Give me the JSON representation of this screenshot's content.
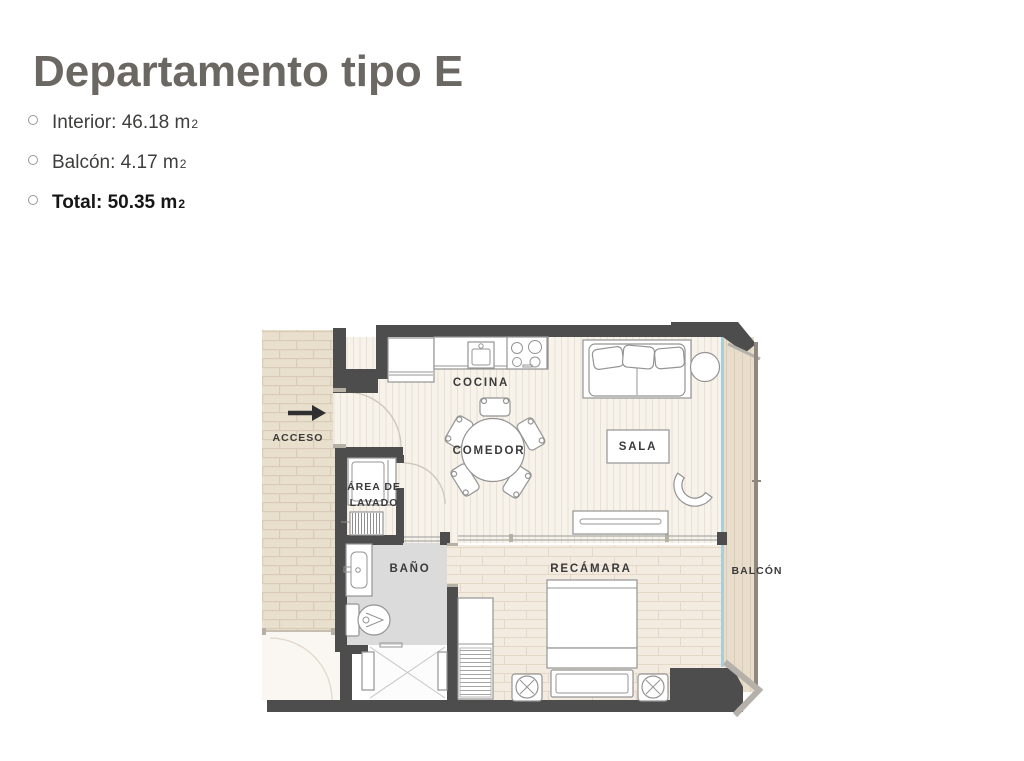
{
  "header": {
    "title": "Departamento tipo E"
  },
  "specs": {
    "items": [
      {
        "text": "Interior: 46.18 m",
        "sup": "2"
      },
      {
        "text": "Balcón: 4.17 m",
        "sup": "2"
      },
      {
        "text": "Total: 50.35 m",
        "sup": "2"
      }
    ]
  },
  "floorplan": {
    "labels": {
      "cocina": "COCINA",
      "comedor": "COMEDOR",
      "sala": "SALA",
      "acceso": "ACCESO",
      "lavado1": "ÁREA DE",
      "lavado2": "LAVADO",
      "bano": "BAÑO",
      "recamara": "RECÁMARA",
      "balcon": "BALCÓN"
    },
    "colors": {
      "wall": "#4d4d4d",
      "floor-living": "#f7f2ea",
      "floor-living-line": "#e8e0d4",
      "floor-bed": "#f3ebe0",
      "floor-bed-line": "#e5d8c7",
      "brick": "#e9dfcd",
      "brick-line": "#d9cbb5",
      "balcony": "#e8ddca",
      "balcony-line": "#d9cdb7",
      "railing": "#8e8880",
      "bath": "#dbdbdb",
      "glass": "#a9ced8",
      "furniture-stroke": "#949494",
      "label": "#3b3b3b",
      "title": "#6b6762",
      "text": "#3f3e3d",
      "arrow": "#2f2f2f",
      "chevron": "#b5b1aa"
    }
  }
}
